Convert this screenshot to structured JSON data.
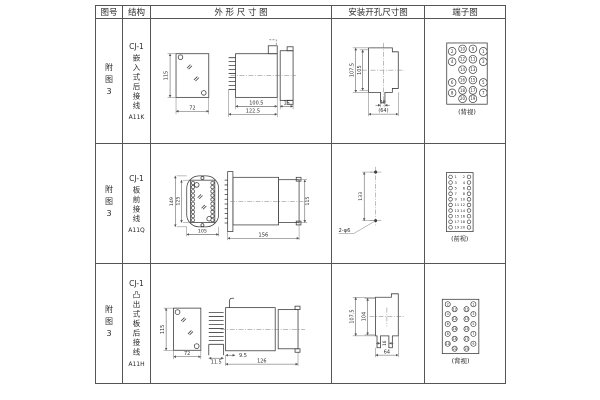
{
  "table": {
    "headers": [
      "图号",
      "结构",
      "外 形 尺 寸 图",
      "安装开孔尺寸图",
      "端子图"
    ]
  },
  "rows": [
    {
      "figure_no": "附图3",
      "model": "CJ-1",
      "structure": "嵌入式后接线",
      "code": "A11K",
      "outline_dims": {
        "front_height": "115",
        "front_width": "72",
        "side_depth": "100.5",
        "side_total": "122.5",
        "side_flange": "15"
      },
      "mounting_dims": {
        "outer_height": "107.5",
        "inner_height": "105",
        "slot_width": "16",
        "opening_width": "(64)"
      },
      "terminal": {
        "label": "(背视)",
        "numbers": [
          "2",
          "10",
          "9",
          "1",
          "4",
          "12",
          "11",
          "3",
          "14",
          "13",
          "6",
          "16",
          "15",
          "5",
          "8",
          "18",
          "17",
          "7",
          "20",
          "19"
        ]
      }
    },
    {
      "figure_no": "附图3",
      "model": "CJ-1",
      "structure": "板前接线",
      "code": "A11Q",
      "outline_dims": {
        "plate_height": "149",
        "window_height": "125",
        "plate_width": "105",
        "side_length": "156",
        "side_height": "115"
      },
      "mounting_dims": {
        "hole_spacing": "133",
        "hole_note": "2-φ6"
      },
      "terminal": {
        "label": "(前视)",
        "left_numbers": [
          "1",
          "3",
          "5",
          "7",
          "9",
          "11",
          "13",
          "15",
          "17",
          "19"
        ],
        "right_numbers": [
          "2",
          "4",
          "6",
          "8",
          "10",
          "12",
          "14",
          "16",
          "18",
          "20"
        ]
      }
    },
    {
      "figure_no": "附图3",
      "model": "CJ-1",
      "structure": "凸出式板后接线",
      "code": "A11H",
      "outline_dims": {
        "front_height": "115",
        "front_width": "72",
        "pin_offset": "9.5",
        "pin_depth": "11.5",
        "side_length": "126"
      },
      "mounting_dims": {
        "outer_height": "107.5",
        "inner_height": "104",
        "slot_width": "16",
        "opening_width": "64"
      },
      "terminal": {
        "label": "(背视)",
        "numbers": [
          [
            "2",
            "4",
            "6",
            "8",
            "10"
          ],
          [
            "12",
            "14",
            "16",
            "18",
            "20"
          ],
          [
            "11",
            "13",
            "15",
            "17",
            "19"
          ],
          [
            "1",
            "3",
            "5",
            "7",
            "9"
          ]
        ]
      }
    }
  ]
}
